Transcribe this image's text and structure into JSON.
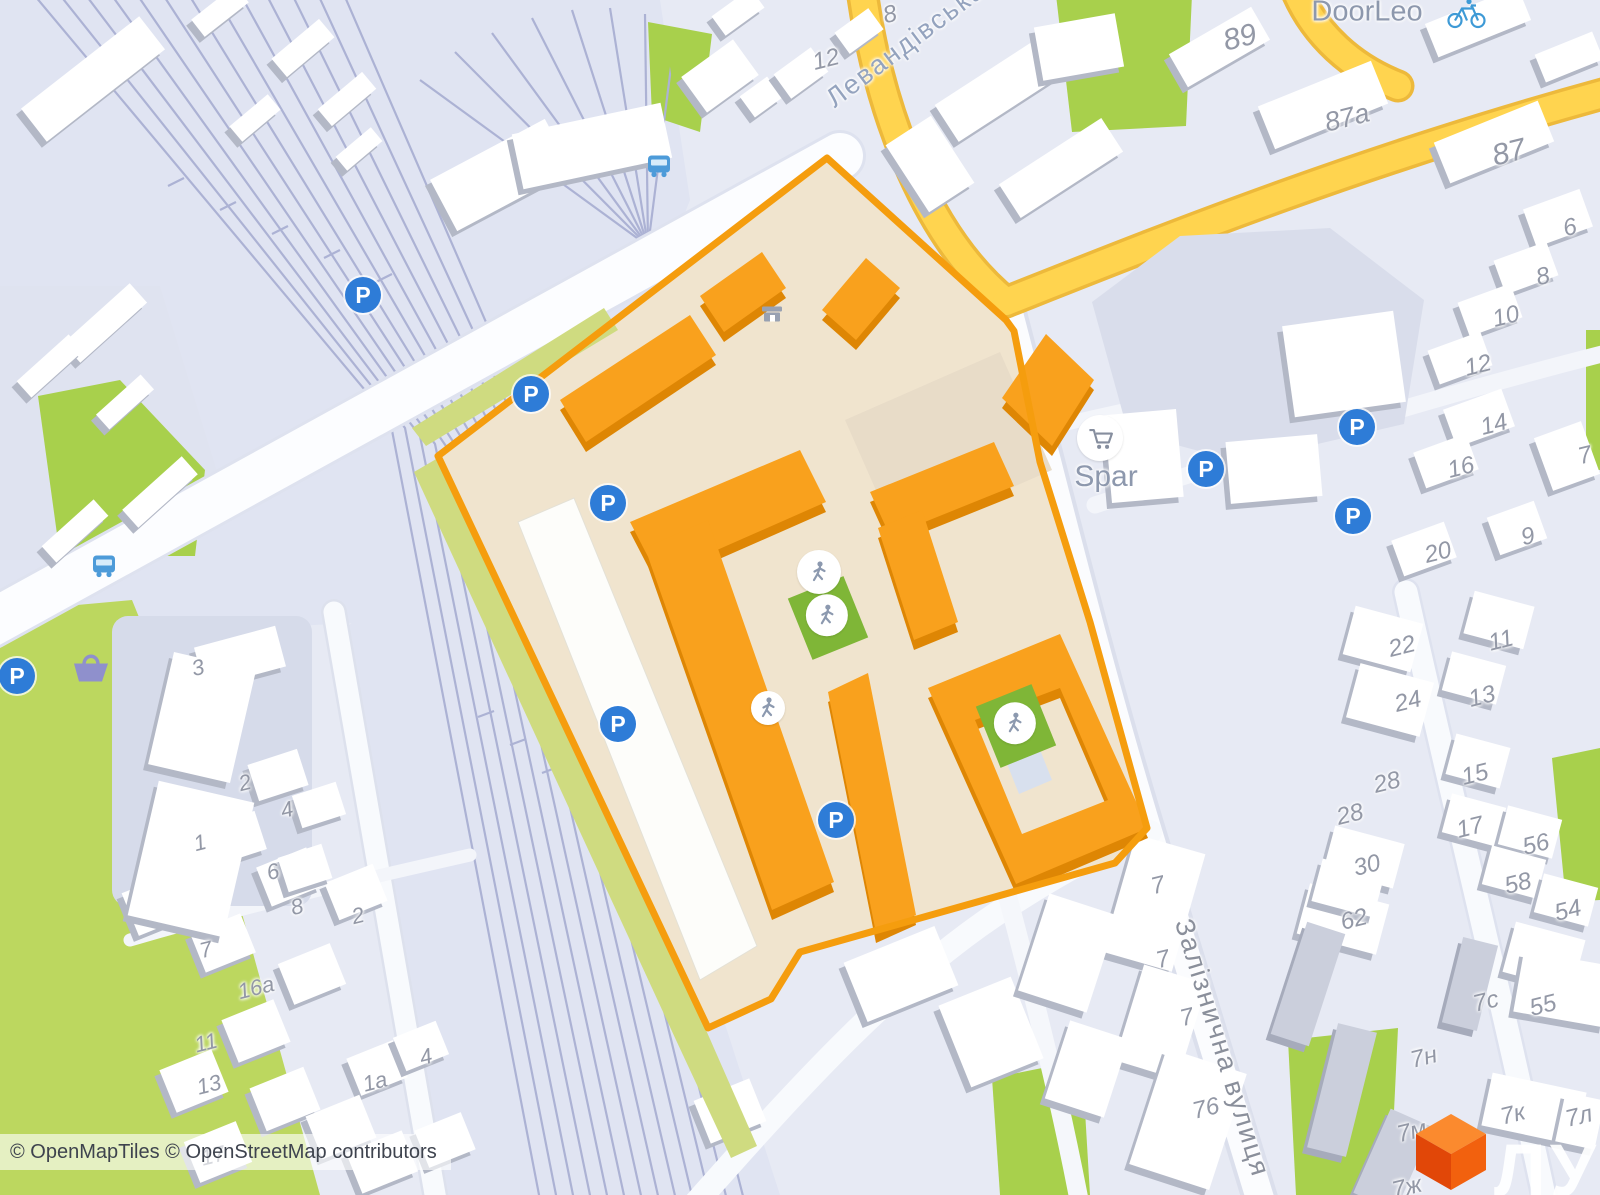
{
  "map": {
    "attribution": "© OpenMapTiles © OpenStreetMap contributors",
    "watermark_text": "ЛУН",
    "icon_glyphs": {
      "parking": "P"
    },
    "colors": {
      "map_bg": "#E7EAF4",
      "highlight_fill": "#F0E4CE",
      "highlight_stroke": "#F59D0E",
      "building_orange_top": "#F9A11D",
      "building_orange_side": "#DE8604",
      "road_yellow": "#FFD44F",
      "road_yellow_casing": "#EDB93B",
      "green": "#A8D04C",
      "green_band": "#CFDB80",
      "rail_line": "#ACB2D4",
      "parking_blue": "#2E7CD7",
      "playground_green": "#7FB637",
      "figure_gray": "#8C99AF",
      "bus_blue": "#4D9BD9",
      "bicycle_blue": "#3E9AD6",
      "cart_gray": "#868E9E",
      "basket_purple": "#8F90CC",
      "logo_top": "#FB8A2E",
      "logo_right": "#F2610E",
      "logo_left": "#E14708"
    },
    "street_labels": [
      {
        "text": "Левандівська",
        "x": 906,
        "y": 44,
        "rot": -37,
        "size": 27,
        "color": "#94A3BE"
      },
      {
        "text": "Залізнична вулиця",
        "x": 1222,
        "y": 1048,
        "rot": 73,
        "size": 27,
        "color": "#8A8F9B"
      }
    ],
    "place_labels": [
      {
        "text": "DoorLeo",
        "x": 1367,
        "y": 12,
        "size": 29
      },
      {
        "text": "Spar",
        "x": 1106,
        "y": 477,
        "size": 30
      }
    ],
    "house_numbers": [
      {
        "t": "8",
        "x": 890,
        "y": 15
      },
      {
        "t": "12",
        "x": 826,
        "y": 60
      },
      {
        "t": "89",
        "x": 1240,
        "y": 38,
        "s": 30
      },
      {
        "t": "87а",
        "x": 1347,
        "y": 118,
        "s": 27
      },
      {
        "t": "87",
        "x": 1509,
        "y": 153,
        "s": 30
      },
      {
        "t": "6",
        "x": 1570,
        "y": 228
      },
      {
        "t": "8",
        "x": 1543,
        "y": 277
      },
      {
        "t": "10",
        "x": 1506,
        "y": 317
      },
      {
        "t": "12",
        "x": 1478,
        "y": 366
      },
      {
        "t": "14",
        "x": 1494,
        "y": 425
      },
      {
        "t": "16",
        "x": 1461,
        "y": 468
      },
      {
        "t": "20",
        "x": 1438,
        "y": 553
      },
      {
        "t": "7",
        "x": 1585,
        "y": 456
      },
      {
        "t": "9",
        "x": 1528,
        "y": 537
      },
      {
        "t": "22",
        "x": 1402,
        "y": 647
      },
      {
        "t": "24",
        "x": 1408,
        "y": 702
      },
      {
        "t": "11",
        "x": 1501,
        "y": 641
      },
      {
        "t": "13",
        "x": 1482,
        "y": 697
      },
      {
        "t": "15",
        "x": 1475,
        "y": 775
      },
      {
        "t": "17",
        "x": 1470,
        "y": 828
      },
      {
        "t": "28",
        "x": 1387,
        "y": 783
      },
      {
        "t": "28",
        "x": 1350,
        "y": 815
      },
      {
        "t": "30",
        "x": 1367,
        "y": 866
      },
      {
        "t": "56",
        "x": 1536,
        "y": 845
      },
      {
        "t": "58",
        "x": 1518,
        "y": 884
      },
      {
        "t": "54",
        "x": 1568,
        "y": 911
      },
      {
        "t": "62",
        "x": 1354,
        "y": 920
      },
      {
        "t": "55",
        "x": 1543,
        "y": 1006
      },
      {
        "t": "7с",
        "x": 1486,
        "y": 1002
      },
      {
        "t": "7н",
        "x": 1424,
        "y": 1058
      },
      {
        "t": "7к",
        "x": 1513,
        "y": 1115
      },
      {
        "t": "7л",
        "x": 1579,
        "y": 1117
      },
      {
        "t": "7м",
        "x": 1412,
        "y": 1132
      },
      {
        "t": "7ж",
        "x": 1407,
        "y": 1188
      },
      {
        "t": "76",
        "x": 1206,
        "y": 1109
      },
      {
        "t": "7",
        "x": 1158,
        "y": 886
      },
      {
        "t": "7",
        "x": 1163,
        "y": 960
      },
      {
        "t": "7",
        "x": 1187,
        "y": 1018
      },
      {
        "t": "3",
        "x": 198,
        "y": 668,
        "s": 22
      },
      {
        "t": "2",
        "x": 245,
        "y": 783,
        "s": 22
      },
      {
        "t": "4",
        "x": 287,
        "y": 810,
        "s": 22
      },
      {
        "t": "1",
        "x": 200,
        "y": 843,
        "s": 22
      },
      {
        "t": "6",
        "x": 273,
        "y": 872,
        "s": 22
      },
      {
        "t": "8",
        "x": 297,
        "y": 907,
        "s": 22
      },
      {
        "t": "7",
        "x": 206,
        "y": 950,
        "s": 22
      },
      {
        "t": "2",
        "x": 358,
        "y": 916,
        "s": 22
      },
      {
        "t": "16а",
        "x": 256,
        "y": 988,
        "s": 22
      },
      {
        "t": "11",
        "x": 206,
        "y": 1043,
        "s": 22
      },
      {
        "t": "13",
        "x": 209,
        "y": 1085,
        "s": 22
      },
      {
        "t": "1а",
        "x": 375,
        "y": 1082,
        "s": 22
      },
      {
        "t": "4",
        "x": 426,
        "y": 1057,
        "s": 22
      },
      {
        "t": "17",
        "x": 213,
        "y": 1156,
        "s": 22
      }
    ],
    "poi_icons": [
      {
        "type": "parking",
        "x": 363,
        "y": 295
      },
      {
        "type": "parking",
        "x": 531,
        "y": 394
      },
      {
        "type": "parking",
        "x": 608,
        "y": 503
      },
      {
        "type": "parking",
        "x": 618,
        "y": 724
      },
      {
        "type": "parking",
        "x": 836,
        "y": 820
      },
      {
        "type": "parking",
        "x": 17,
        "y": 676
      },
      {
        "type": "parking",
        "x": 1206,
        "y": 469
      },
      {
        "type": "parking",
        "x": 1357,
        "y": 427
      },
      {
        "type": "parking",
        "x": 1353,
        "y": 516
      },
      {
        "type": "bus",
        "x": 659,
        "y": 168
      },
      {
        "type": "bus",
        "x": 104,
        "y": 568
      },
      {
        "type": "bicycle",
        "x": 1467,
        "y": 16
      },
      {
        "type": "cart",
        "x": 1100,
        "y": 438
      },
      {
        "type": "basket",
        "x": 90,
        "y": 670
      },
      {
        "type": "shop",
        "x": 772,
        "y": 316
      },
      {
        "type": "playground-square",
        "x": 828,
        "y": 618
      },
      {
        "type": "playground-square",
        "x": 1016,
        "y": 726
      },
      {
        "type": "playground-person",
        "x": 819,
        "y": 572,
        "d": 44
      },
      {
        "type": "playground-person",
        "x": 768,
        "y": 708,
        "d": 34
      }
    ]
  }
}
